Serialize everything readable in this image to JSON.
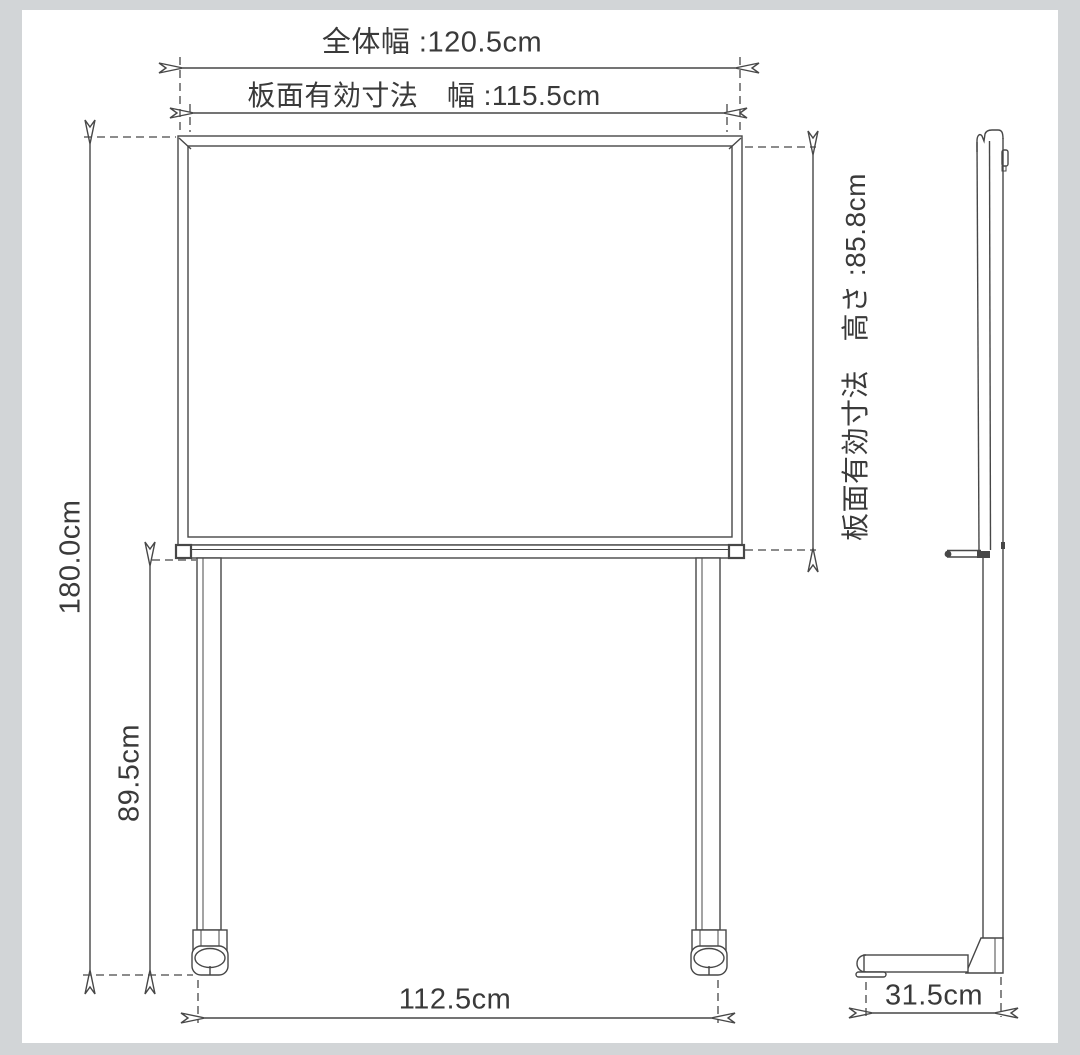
{
  "page": {
    "background_color": "#d2d5d7",
    "canvas_color": "#ffffff",
    "line_color": "#474747",
    "text_color": "#3a3a3a"
  },
  "diagram": {
    "type": "product-dimension-drawing",
    "subject": "mobile-whiteboard",
    "views": [
      "front-view",
      "side-view"
    ],
    "dimensions": {
      "total_width": {
        "label": "全体幅 :120.5cm",
        "value_cm": 120.5
      },
      "board_width": {
        "label": "板面有効寸法　幅 :115.5cm",
        "value_cm": 115.5
      },
      "board_height": {
        "label": "板面有効寸法　高さ :85.8cm",
        "value_cm": 85.8
      },
      "total_height": {
        "label": "180.0cm",
        "value_cm": 180.0
      },
      "leg_height": {
        "label": "89.5cm",
        "value_cm": 89.5
      },
      "caster_span": {
        "label": "112.5cm",
        "value_cm": 112.5
      },
      "depth": {
        "label": "31.5cm",
        "value_cm": 31.5
      }
    }
  }
}
